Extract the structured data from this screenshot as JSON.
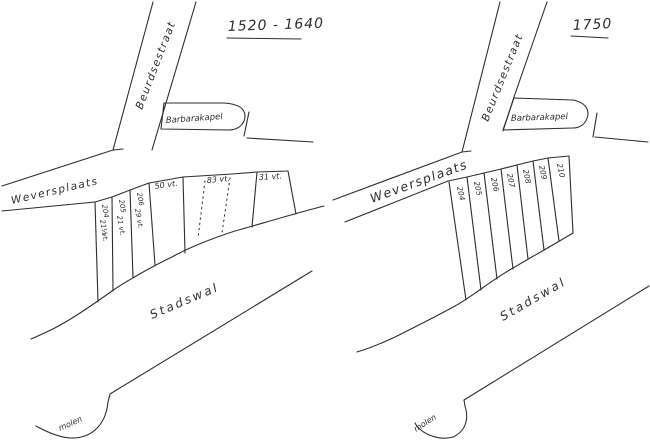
{
  "ink": "#2e2e2e",
  "background": "#ffffff",
  "panels": [
    {
      "title": "1520 - 1640",
      "street_main": "Beurdsestraat",
      "street_cross": "Weversplaats",
      "chapel": "Barbarakapel",
      "wall": "Stadswal",
      "mill": "molen",
      "plots": [
        {
          "number": "204",
          "width": "21½",
          "unit": "vt."
        },
        {
          "number": "205",
          "width": "21",
          "unit": "vt."
        },
        {
          "number": "206",
          "width": "29",
          "unit": "vt."
        },
        {
          "label": "50 vt."
        },
        {
          "label": "83 vt."
        },
        {
          "label": "31 vt."
        }
      ]
    },
    {
      "title": "1750",
      "street_main": "Beurdsestraat",
      "street_cross": "Weversplaats",
      "chapel": "Barbarakapel",
      "wall": "Stadswal",
      "mill": "molen",
      "plots": [
        {
          "number": "204"
        },
        {
          "number": "205"
        },
        {
          "number": "206"
        },
        {
          "number": "207"
        },
        {
          "number": "208"
        },
        {
          "number": "209"
        },
        {
          "number": "210"
        }
      ]
    }
  ]
}
